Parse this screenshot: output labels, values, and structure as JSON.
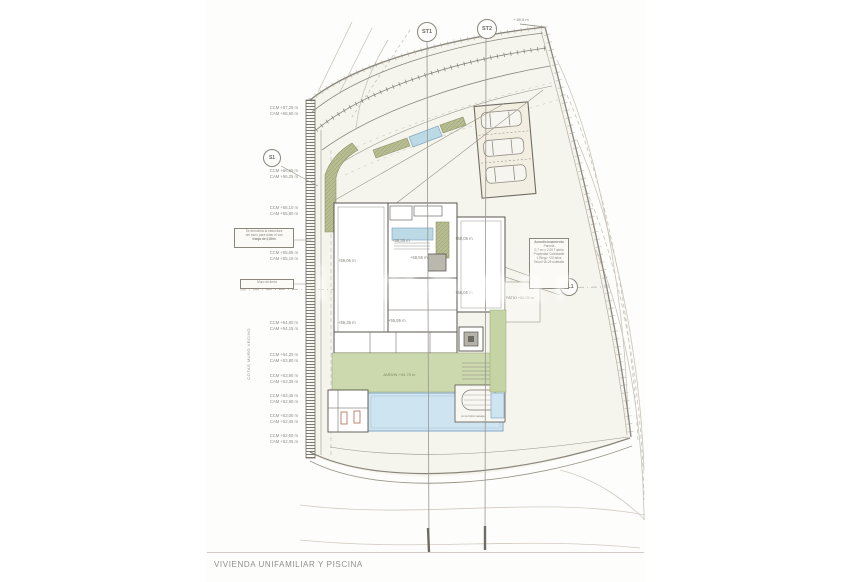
{
  "title_cropped": "BASEMENT PLAN",
  "caption": "VIVIENDA UNIFAMILIAR Y PISCINA",
  "watermark": "inmomar",
  "markers": {
    "st1": "ST1",
    "st2": "ST2",
    "s1": "S1",
    "sl1": "SL1"
  },
  "top_corner_elevation": "+ 59,5 m",
  "rotated_label": "COTAS MURO VECINO",
  "left_labels": [
    {
      "ccm": "CCM +57,25 m",
      "cam": "CAM +56,50 m"
    },
    {
      "ccm": "CCM +56,65 m",
      "cam": "CAM +56,25 m"
    },
    {
      "ccm": "CCM +56,10 m",
      "cam": "CAM +55,60 m"
    },
    {
      "ccm": "CCM +55,65 m",
      "cam": "CAM +55,15 m"
    },
    {
      "ccm": "CCM +54,80 m",
      "cam": "CAM +54,15 m"
    },
    {
      "ccm": "CCM +54,30 m",
      "cam": "CAM +53,80 m"
    },
    {
      "ccm": "CCM +53,90 m",
      "cam": "CAM +53,35 m"
    },
    {
      "ccm": "CCM +53,45 m",
      "cam": "CAM +52,90 m"
    },
    {
      "ccm": "CCM +53,00 m",
      "cam": "CAM +52,45 m"
    },
    {
      "ccm": "CCM +52,60 m",
      "cam": "CAM +52,05 m"
    }
  ],
  "left_box_a": {
    "line1": "Se demolerá la estructura",
    "line2": "del muro para dotar el vial",
    "line3": "franja de 0,80m"
  },
  "left_box_b": {
    "line1": "Muro de tierra"
  },
  "house_labels": [
    {
      "text": "+59,05 m"
    },
    {
      "text": "+58,35 m"
    },
    {
      "text": "+58,55 m"
    },
    {
      "text": "+58,05 m"
    },
    {
      "text": "+56,05 m"
    },
    {
      "text": "+55,95 m"
    },
    {
      "text": "+56,35 m"
    }
  ],
  "patio_label": "PATIO +55,05 m",
  "garden_label": "JARDIN +54,75 m",
  "spa_label": "zona hidromasaje",
  "note_box": {
    "line1": "Acondicionamiento",
    "line2": "Parcela",
    "line3": "0,7 m² x 2,00 Tudela",
    "line4": "Propiedad Colindante",
    "line5": "1 Riego +20 años",
    "line6": "Talud HA-25 s/detalle"
  },
  "colors": {
    "lawn": "#ccd8ad",
    "planter": "#b9bd92",
    "pool": "#cfe4f1",
    "entry_water": "#bcd9e6",
    "parking": "#f2eee1",
    "wall": "#59564e",
    "boundary": "#8a867c",
    "contour": "#c9c4b9"
  }
}
